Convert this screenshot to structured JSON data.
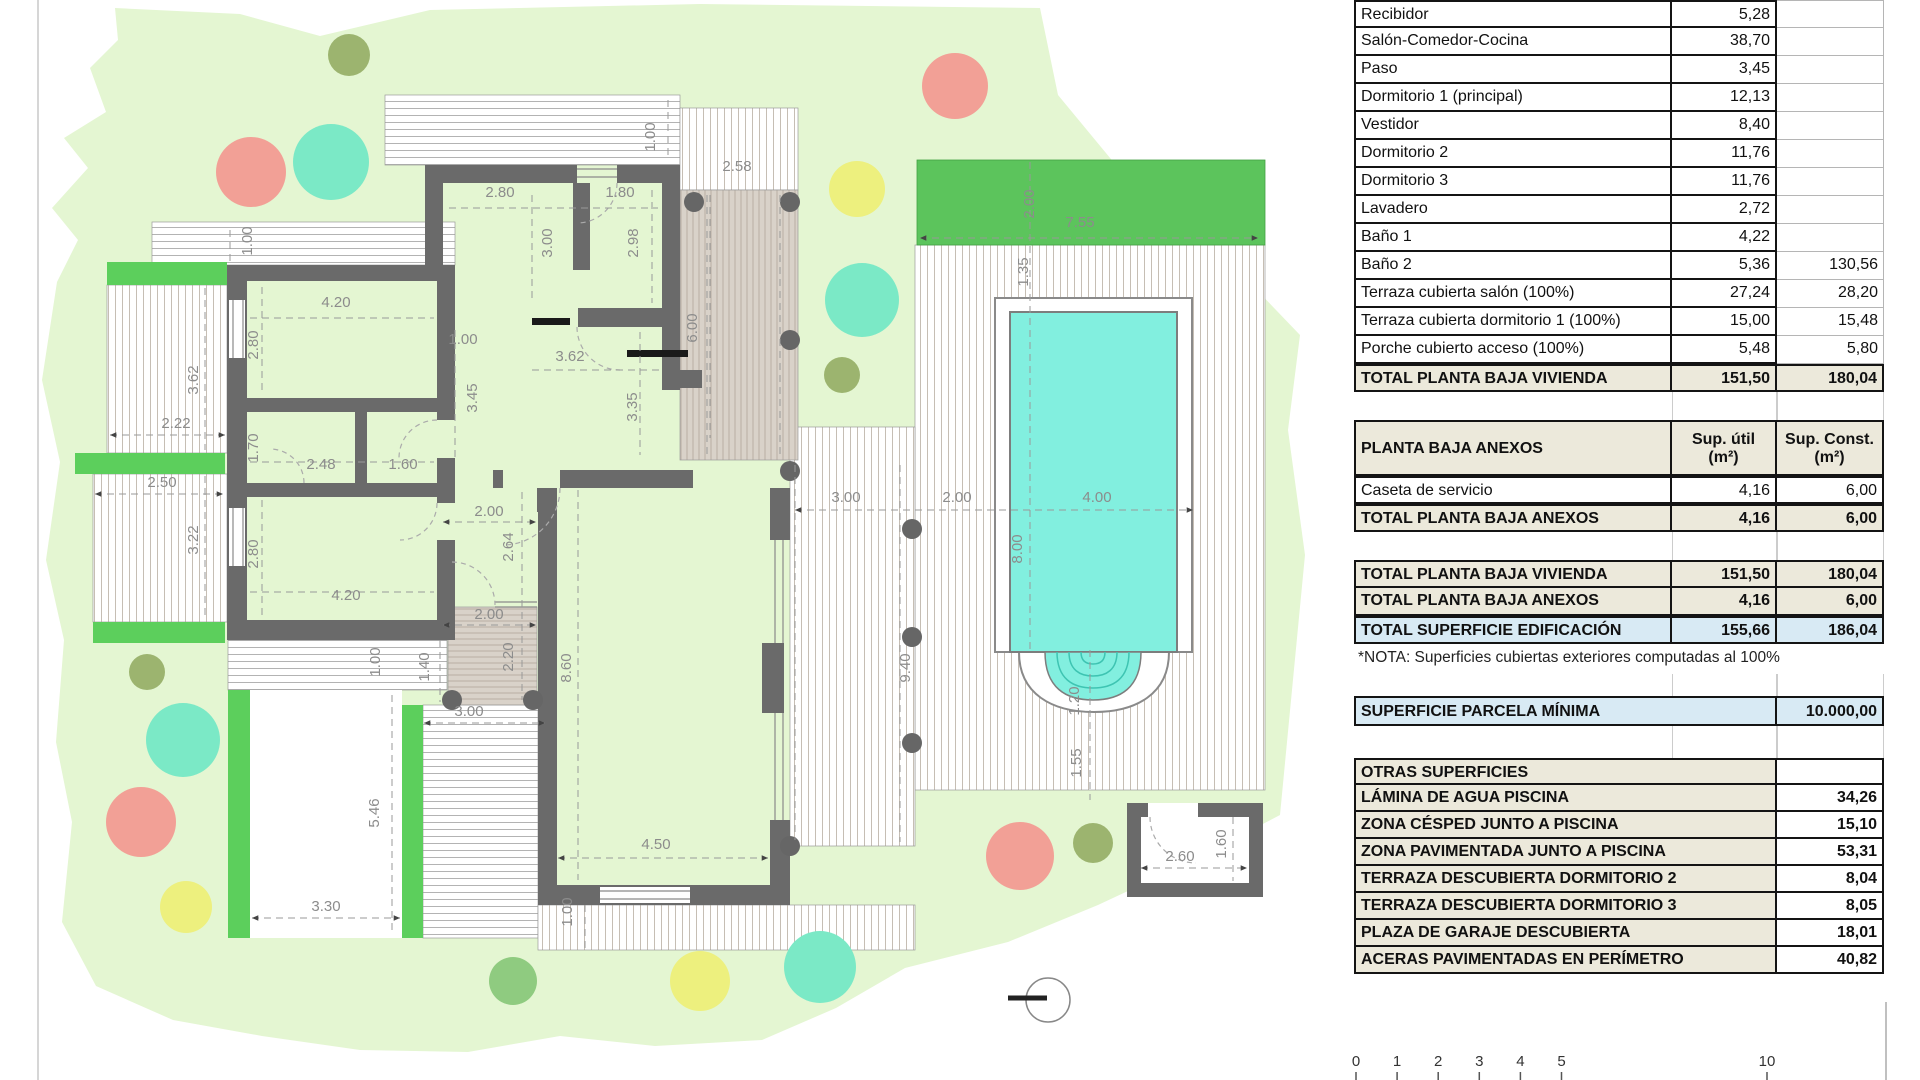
{
  "plan": {
    "colors": {
      "parcel": "#E4F6D2",
      "lawn": "#5CC45C",
      "planter": "#5CCF5C",
      "wall": "#6A6A6A",
      "pool_water": "#82EFDF",
      "pool_steps_line": "#3EC4B2",
      "tan_terrace": "#D9D2C9",
      "dim_text": "#8C8C8C",
      "tree_salmon": "#F2A096",
      "tree_mint": "#7BE9C6",
      "tree_yellow": "#EDF07E",
      "tree_green": "#8FCB80",
      "tree_olive": "#9CB46F"
    },
    "dimension_labels": [
      {
        "t": "1.00",
        "x": 655,
        "y": 137,
        "v": 1
      },
      {
        "t": "2.80",
        "x": 500,
        "y": 197
      },
      {
        "t": "1.80",
        "x": 620,
        "y": 197
      },
      {
        "t": "2.58",
        "x": 737,
        "y": 171
      },
      {
        "t": "3.00",
        "x": 552,
        "y": 243,
        "v": 1
      },
      {
        "t": "2.98",
        "x": 638,
        "y": 243,
        "v": 1
      },
      {
        "t": "6.00",
        "x": 697,
        "y": 328,
        "v": 1
      },
      {
        "t": "1.00",
        "x": 252,
        "y": 241,
        "v": 1
      },
      {
        "t": "4.20",
        "x": 336,
        "y": 307
      },
      {
        "t": "2.80",
        "x": 258,
        "y": 345,
        "v": 1
      },
      {
        "t": "3.62",
        "x": 198,
        "y": 380,
        "v": 1
      },
      {
        "t": "2.22",
        "x": 176,
        "y": 428
      },
      {
        "t": "1.00",
        "x": 463,
        "y": 344
      },
      {
        "t": "3.45",
        "x": 477,
        "y": 398,
        "v": 1
      },
      {
        "t": "3.62",
        "x": 570,
        "y": 361
      },
      {
        "t": "3.35",
        "x": 637,
        "y": 407,
        "v": 1
      },
      {
        "t": "1.70",
        "x": 258,
        "y": 448,
        "v": 1
      },
      {
        "t": "2.48",
        "x": 321,
        "y": 469
      },
      {
        "t": "1.60",
        "x": 403,
        "y": 469
      },
      {
        "t": "2.50",
        "x": 162,
        "y": 487
      },
      {
        "t": "3.22",
        "x": 198,
        "y": 540,
        "v": 1
      },
      {
        "t": "2.80",
        "x": 258,
        "y": 554,
        "v": 1
      },
      {
        "t": "4.20",
        "x": 346,
        "y": 600
      },
      {
        "t": "2.00",
        "x": 489,
        "y": 516
      },
      {
        "t": "2.64",
        "x": 513,
        "y": 547,
        "v": 1
      },
      {
        "t": "2.00",
        "x": 489,
        "y": 619
      },
      {
        "t": "2.20",
        "x": 513,
        "y": 657,
        "v": 1
      },
      {
        "t": "1.40",
        "x": 429,
        "y": 667,
        "v": 1
      },
      {
        "t": "8.60",
        "x": 571,
        "y": 668,
        "v": 1
      },
      {
        "t": "1.00",
        "x": 380,
        "y": 662,
        "v": 1
      },
      {
        "t": "3.00",
        "x": 469,
        "y": 716
      },
      {
        "t": "5.46",
        "x": 379,
        "y": 813,
        "v": 1
      },
      {
        "t": "3.30",
        "x": 326,
        "y": 911
      },
      {
        "t": "1.00",
        "x": 572,
        "y": 912,
        "v": 1
      },
      {
        "t": "4.50",
        "x": 656,
        "y": 849
      },
      {
        "t": "3.00",
        "x": 846,
        "y": 502
      },
      {
        "t": "2.00",
        "x": 957,
        "y": 502
      },
      {
        "t": "4.00",
        "x": 1097,
        "y": 502
      },
      {
        "t": "8.00",
        "x": 1022,
        "y": 549,
        "v": 1
      },
      {
        "t": "9.40",
        "x": 910,
        "y": 668,
        "v": 1
      },
      {
        "t": "1.20",
        "x": 1079,
        "y": 701,
        "v": 1
      },
      {
        "t": "1.55",
        "x": 1081,
        "y": 763,
        "v": 1
      },
      {
        "t": "2.00",
        "x": 1034,
        "y": 204,
        "v": 1
      },
      {
        "t": "7.55",
        "x": 1080,
        "y": 227
      },
      {
        "t": "1.35",
        "x": 1028,
        "y": 272,
        "v": 1
      },
      {
        "t": "2.60",
        "x": 1180,
        "y": 861
      },
      {
        "t": "1.60",
        "x": 1226,
        "y": 844,
        "v": 1
      }
    ],
    "scale_bar": {
      "labels": [
        "0",
        "1",
        "2",
        "3",
        "4",
        "5",
        "10"
      ]
    }
  },
  "tables": {
    "vivienda": {
      "rows": [
        {
          "label": "Recibidor",
          "util": "5,28",
          "const": ""
        },
        {
          "label": "Salón-Comedor-Cocina",
          "util": "38,70",
          "const": ""
        },
        {
          "label": "Paso",
          "util": "3,45",
          "const": ""
        },
        {
          "label": "Dormitorio 1 (principal)",
          "util": "12,13",
          "const": ""
        },
        {
          "label": "Vestidor",
          "util": "8,40",
          "const": ""
        },
        {
          "label": "Dormitorio 2",
          "util": "11,76",
          "const": ""
        },
        {
          "label": "Dormitorio 3",
          "util": "11,76",
          "const": ""
        },
        {
          "label": "Lavadero",
          "util": "2,72",
          "const": ""
        },
        {
          "label": "Baño 1",
          "util": "4,22",
          "const": ""
        },
        {
          "label": "Baño 2",
          "util": "5,36",
          "const": "130,56"
        },
        {
          "label": "Terraza cubierta salón (100%)",
          "util": "27,24",
          "const": "28,20"
        },
        {
          "label": "Terraza cubierta dormitorio 1 (100%)",
          "util": "15,00",
          "const": "15,48"
        },
        {
          "label": "Porche cubierto acceso (100%)",
          "util": "5,48",
          "const": "5,80"
        }
      ],
      "total": [
        {
          "label": "TOTAL PLANTA BAJA VIVIENDA",
          "util": "151,50",
          "const": "180,04"
        }
      ]
    },
    "anexos": {
      "title": "PLANTA BAJA ANEXOS",
      "col_util_1": "Sup. útil",
      "col_util_2": "(m²)",
      "col_const_1": "Sup. Const.",
      "col_const_2": "(m²)",
      "rows": [
        {
          "label": "Caseta de servicio",
          "util": "4,16",
          "const": "6,00"
        }
      ],
      "total": [
        {
          "label": "TOTAL PLANTA BAJA ANEXOS",
          "util": "4,16",
          "const": "6,00"
        }
      ]
    },
    "resumen": {
      "rows": [
        {
          "label": "TOTAL PLANTA BAJA VIVIENDA",
          "util": "151,50",
          "const": "180,04"
        },
        {
          "label": "TOTAL PLANTA BAJA ANEXOS",
          "util": "4,16",
          "const": "6,00"
        }
      ],
      "total": [
        {
          "label": "TOTAL SUPERFICIE EDIFICACIÓN",
          "util": "155,66",
          "const": "186,04"
        }
      ]
    },
    "nota": "*NOTA: Superficies cubiertas exteriores computadas al 100%",
    "parcela": {
      "label": "SUPERFICIE PARCELA MÍNIMA",
      "value": "10.000,00"
    },
    "otras": {
      "rows": [
        {
          "label": "OTRAS SUPERFICIES",
          "value": ""
        },
        {
          "label": "LÁMINA DE AGUA PISCINA",
          "value": "34,26"
        },
        {
          "label": "ZONA CÉSPED JUNTO A PISCINA",
          "value": "15,10"
        },
        {
          "label": "ZONA PAVIMENTADA JUNTO A PISCINA",
          "value": "53,31"
        },
        {
          "label": "TERRAZA DESCUBIERTA DORMITORIO 2",
          "value": "8,04"
        },
        {
          "label": "TERRAZA DESCUBIERTA DORMITORIO 3",
          "value": "8,05"
        },
        {
          "label": "PLAZA DE GARAJE DESCUBIERTA",
          "value": "18,01"
        },
        {
          "label": "ACERAS PAVIMENTADAS EN PERÍMETRO",
          "value": "40,82"
        }
      ]
    }
  }
}
